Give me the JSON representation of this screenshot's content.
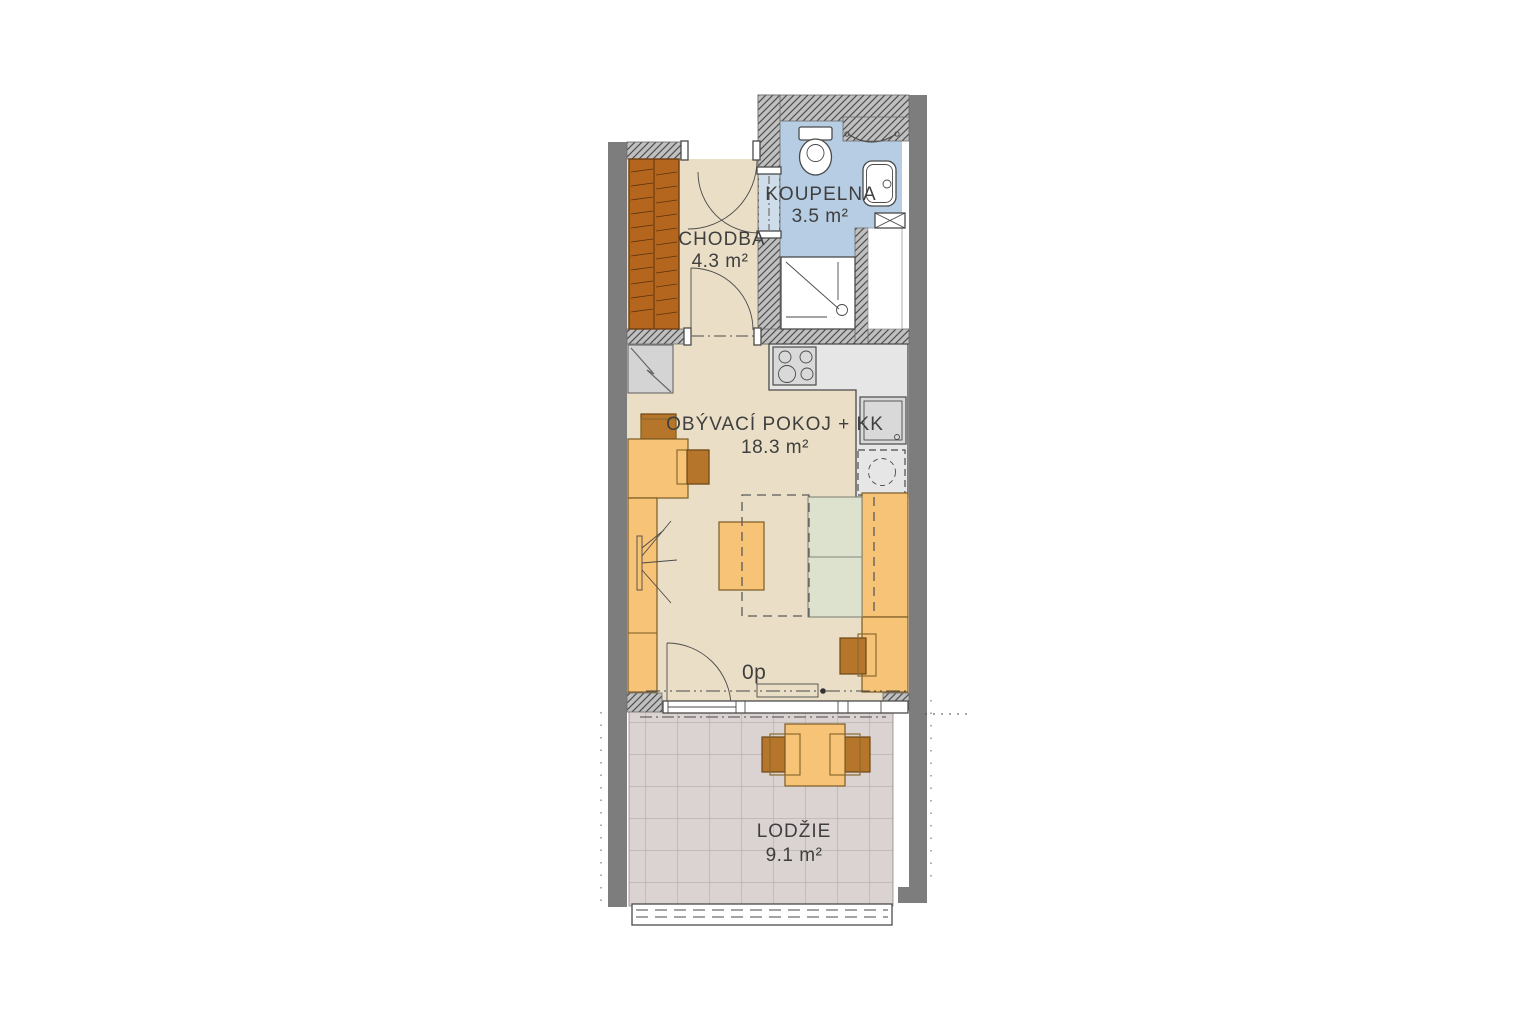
{
  "plan_title": "apartment-floor-plan",
  "rooms": {
    "chodba": {
      "name": "CHODBA",
      "area": "4.3 m²"
    },
    "koupelna": {
      "name": "KOUPELNA",
      "area": "3.5 m²"
    },
    "obyvaci_pokoj": {
      "name": "OBÝVACÍ POKOJ + KK",
      "area": "18.3 m²"
    },
    "lodzie": {
      "name": "LODŽIE",
      "area": "9.1 m²"
    }
  },
  "markers": {
    "floor_level": "0p"
  },
  "colors": {
    "wall_solid": "#7D7D7D",
    "wall_hatched": "#C0C0C0",
    "floor_main": "#EADFC6",
    "floor_bathroom": "#B7CDE3",
    "floor_loggia": "#DBD3D1",
    "furniture_light": "#F6C377",
    "furniture_dark": "#B5762B",
    "wardrobe": "#B4661E",
    "sofa_cushion": "#DDE2CE",
    "kitchen_counter": "#E6E6E6",
    "text": "#3F3F3F"
  },
  "fixtures": [
    "entrance-door",
    "wardrobe",
    "bathroom-door",
    "toilet",
    "towel-rail",
    "washbasin",
    "shower",
    "ventilation-shaft",
    "installation-shaft",
    "cooktop",
    "kitchen-counter",
    "kitchen-sink",
    "washing-machine",
    "boiler",
    "desk",
    "desk-chair",
    "tv",
    "wall-cabinet",
    "coffee-table",
    "sofa",
    "fold-out-bed-outline",
    "side-chair",
    "balcony-door",
    "window",
    "floor-convector",
    "loggia-table",
    "loggia-chair",
    "railing"
  ]
}
